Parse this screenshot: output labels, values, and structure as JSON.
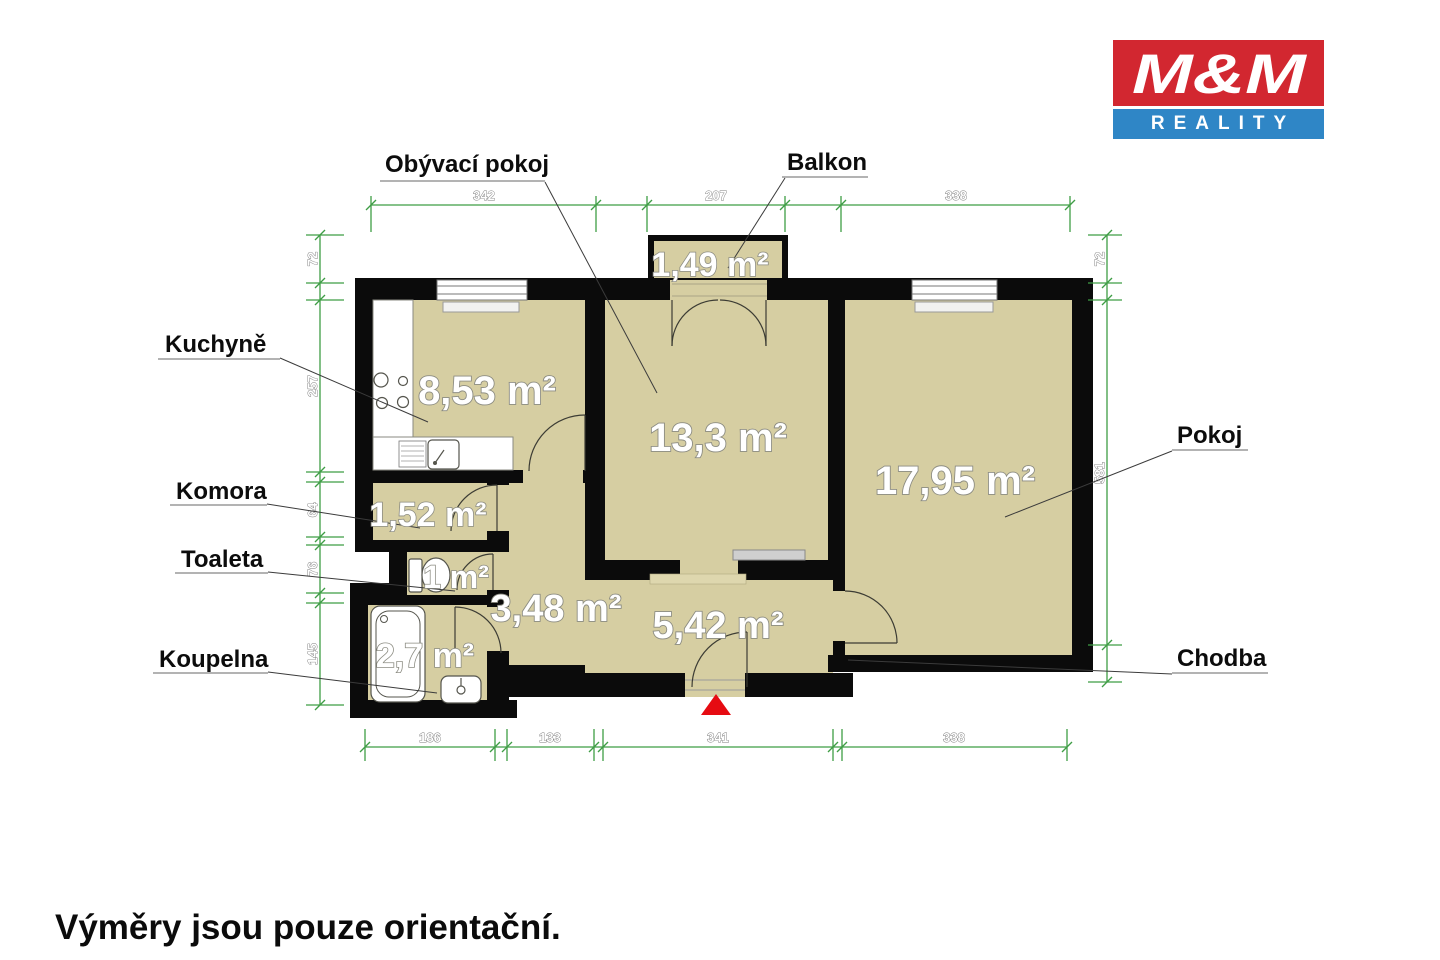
{
  "logo": {
    "top": "M&M",
    "bottom": "REALITY"
  },
  "disclaimer": "Výměry jsou pouze orientační.",
  "room_labels": {
    "kuchyne": "Kuchyně",
    "komora": "Komora",
    "toaleta": "Toaleta",
    "koupelna": "Koupelna",
    "obyvaci_pokoj": "Obývací pokoj",
    "balkon": "Balkon",
    "pokoj": "Pokoj",
    "chodba": "Chodba"
  },
  "areas": {
    "balkon": "1,49 m²",
    "kuchyne": "8,53 m²",
    "obyvaci_pokoj": "13,3 m²",
    "pokoj": "17,95 m²",
    "komora": "1,52 m²",
    "toaleta": "1 m²",
    "chodba_vnitrni": "3,48 m²",
    "chodba": "5,42 m²",
    "koupelna": "2,7 m²"
  },
  "dimensions": {
    "top": [
      "342",
      "207",
      "338"
    ],
    "bottom": [
      "186",
      "133",
      "341",
      "338"
    ],
    "left": [
      "72",
      "257",
      "64",
      "76",
      "145"
    ],
    "right": [
      "72",
      "581"
    ]
  },
  "colors": {
    "wall": "#0b0b0b",
    "floor": "#d6cea2",
    "dimension_green": "#3f9d45",
    "logo_red": "#d22730",
    "logo_blue": "#2f86c6",
    "entrance_red": "#e60b12"
  }
}
